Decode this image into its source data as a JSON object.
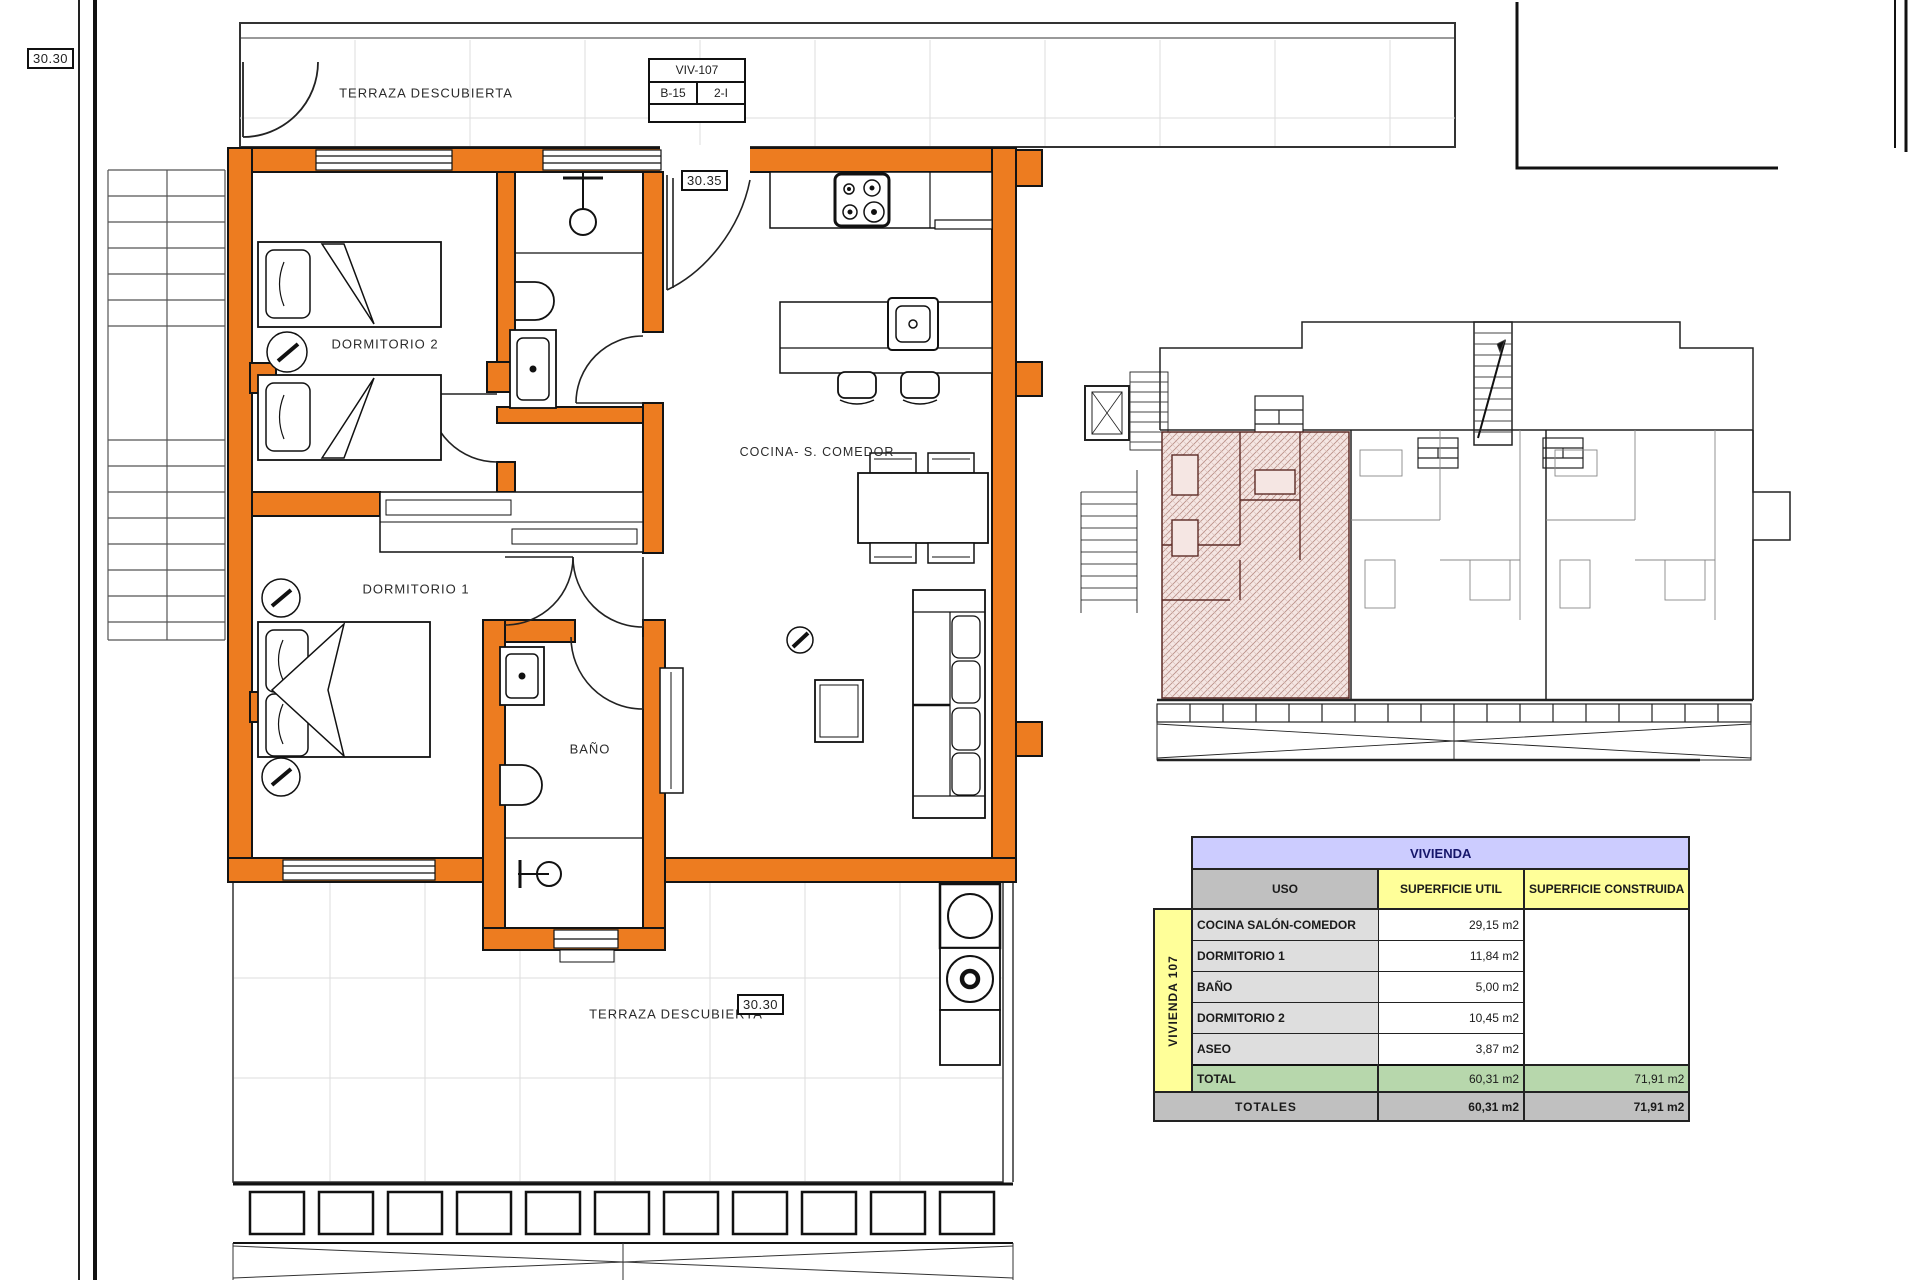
{
  "labels": {
    "level_top_left": "30.30",
    "entry_level": "30.35",
    "terrace_level": "30.30",
    "terrace_top": "TERRAZA DESCUBIERTA",
    "terrace_bottom": "TERRAZA DESCUBIERTA",
    "dormitorio2": "DORMITORIO 2",
    "dormitorio1": "DORMITORIO 1",
    "bano": "BAÑO",
    "cocina_comedor": "COCINA- S. COMEDOR"
  },
  "title_block": {
    "unit": "VIV-107",
    "block": "B-15",
    "portal": "2-I"
  },
  "area_table": {
    "title": "VIVIENDA",
    "group_label": "VIVIENDA 107",
    "col_uso": "USO",
    "col_util": "SUPERFICIE UTIL",
    "col_construida": "SUPERFICIE CONSTRUIDA",
    "rows": [
      {
        "uso": "COCINA SALÓN-COMEDOR",
        "util": "29,15 m2"
      },
      {
        "uso": "DORMITORIO 1",
        "util": "11,84 m2"
      },
      {
        "uso": "BAÑO",
        "util": "5,00 m2"
      },
      {
        "uso": "DORMITORIO 2",
        "util": "10,45 m2"
      },
      {
        "uso": "ASEO",
        "util": "3,87 m2"
      }
    ],
    "total_label": "TOTAL",
    "total_util": "60,31 m2",
    "total_construida": "71,91 m2",
    "totales_label": "TOTALES",
    "totales_util": "60,31 m2",
    "totales_construida": "71,91 m2"
  },
  "colors": {
    "wall_highlight": "#ED7C20",
    "hatch_fill": "#F5E6E3",
    "hatch_line": "#B98E86",
    "table_title_bg": "#CCCCFF",
    "table_header_yellow": "#FFFF99",
    "table_total_green": "#B7D7AC",
    "table_gray": "#C0C0C0"
  }
}
